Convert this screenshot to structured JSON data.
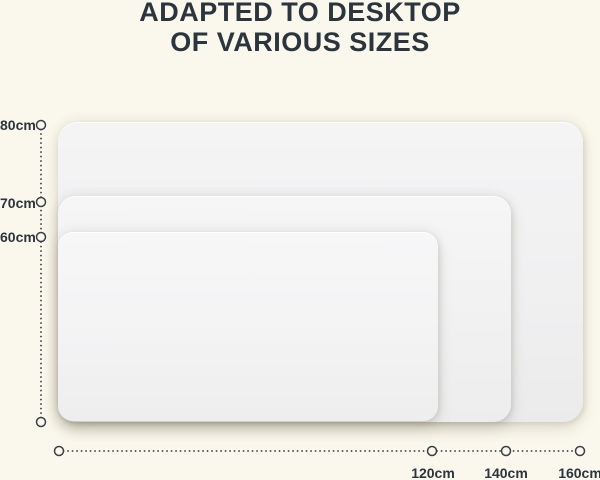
{
  "title": {
    "line1": "ADAPTED TO DESKTOP",
    "line2": "OF VARIOUS SIZES"
  },
  "height_axis": {
    "labels": [
      "80cm",
      "70cm",
      "60cm"
    ]
  },
  "width_axis": {
    "labels": [
      "120cm",
      "140cm",
      "160cm"
    ]
  },
  "mats": [
    {
      "name": "large desk mat",
      "width_label": "160cm",
      "height_label": "80cm"
    },
    {
      "name": "medium desk mat",
      "width_label": "140cm",
      "height_label": "70cm"
    },
    {
      "name": "small desk mat",
      "width_label": "120cm",
      "height_label": "60cm"
    }
  ],
  "colors": {
    "background": "#faf7ec",
    "text": "#2b353e",
    "axis_dots": "#3a4046",
    "mat_fill": "#f1f1f2"
  }
}
